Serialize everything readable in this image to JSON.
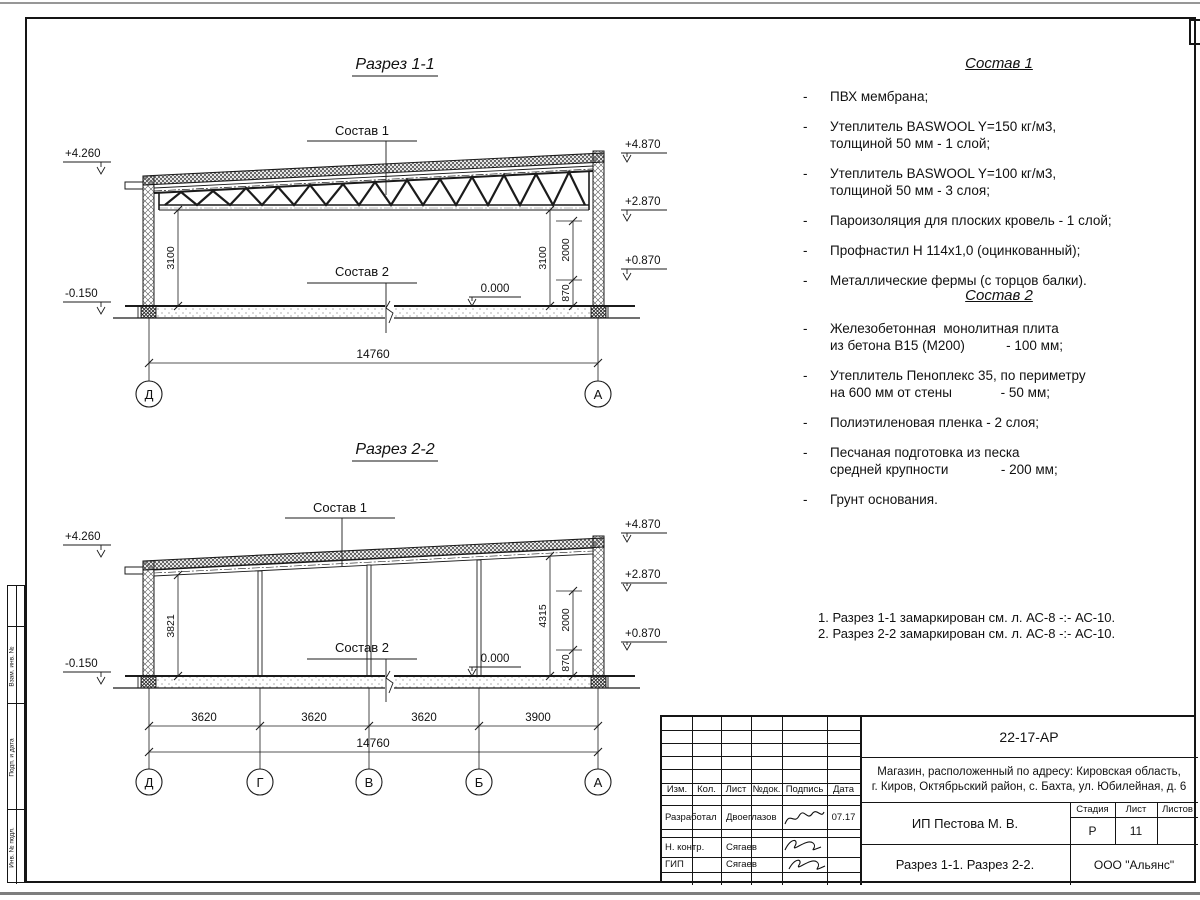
{
  "labels": {
    "sostav1": "Состав 1",
    "sostav2": "Состав 2",
    "zero": "0.000"
  },
  "sections": {
    "s1": {
      "title": "Разрез 1-1",
      "elev_left_top": "+4.260",
      "elev_left_bot": "-0.150",
      "elev_r1": "+4.870",
      "elev_r2": "+2.870",
      "elev_r3": "+0.870",
      "dim_left": "3100",
      "dim_right": "3100",
      "dim_2000": "2000",
      "dim_870": "870",
      "dim_total": "14760",
      "axis_left": "Д",
      "axis_right": "А"
    },
    "s2": {
      "title": "Разрез 2-2",
      "elev_left_top": "+4.260",
      "elev_left_bot": "-0.150",
      "elev_r1": "+4.870",
      "elev_r2": "+2.870",
      "elev_r3": "+0.870",
      "dim_left": "3821",
      "dim_right": "4315",
      "dim_2000": "2000",
      "dim_870": "870",
      "bays": [
        "3620",
        "3620",
        "3620",
        "3900"
      ],
      "dim_total": "14760",
      "axes": [
        "Д",
        "Г",
        "В",
        "Б",
        "А"
      ]
    }
  },
  "composition1": {
    "title": "Состав 1",
    "bullet": "-",
    "items": [
      "ПВХ мембрана;",
      "Утеплитель BASWOOL Y=150 кг/м3,\nтолщиной 50 мм - 1 слой;",
      "Утеплитель BASWOOL Y=100 кг/м3,\nтолщиной 50 мм - 3 слоя;",
      "Пароизоляция для плоских кровель - 1 слой;",
      "Профнастил Н 114х1,0 (оцинкованный);",
      "Металлические фермы (с торцов балки)."
    ]
  },
  "composition2": {
    "title": "Состав 2",
    "bullet": "-",
    "items": [
      "Железобетонная  монолитная плита\nиз бетона В15 (М200)           - 100 мм;",
      "Утеплитель Пеноплекс 35, по периметру\nна 600 мм от стены             - 50 мм;",
      "Полиэтиленовая пленка - 2 слоя;",
      "Песчаная подготовка из песка\nсредней крупности              - 200 мм;",
      "Грунт основания."
    ]
  },
  "notes": [
    "1. Разрез 1-1 замаркирован см. л. АС-8 -:- АС-10.",
    "2. Разрез 2-2 замаркирован см. л. АС-8 -:- АС-10."
  ],
  "titleblock": {
    "doc_code": "22-17-АР",
    "address_line1": "Магазин, расположенный по адресу: Кировская область,",
    "address_line2": "г. Киров, Октябрьский район, с. Бахта, ул. Юбилейная, д. 6",
    "h_izm": "Изм.",
    "h_kol": "Кол.",
    "h_list": "Лист",
    "h_ndok": "№док.",
    "h_podpis": "Подпись",
    "h_data": "Дата",
    "row1_role": "Разработал",
    "row1_name": "Двоеглазов",
    "row1_date": "07.17",
    "row2_role": "Н. контр.",
    "row2_name": "Сягаев",
    "row3_role": "ГИП",
    "row3_name": "Сягаев",
    "client": "ИП Пестова М. В.",
    "stage_label": "Стадия",
    "sheet_label": "Лист",
    "sheets_label": "Листов",
    "stage": "Р",
    "sheet_no": "11",
    "sheets_total": "",
    "sheet_title": "Разрез 1-1. Разрез 2-2.",
    "company": "ООО \"Альянс\""
  },
  "side_strip": {
    "labels": [
      "Взам. инв. №",
      "Подп. и дата",
      "Инв. № подл."
    ]
  }
}
